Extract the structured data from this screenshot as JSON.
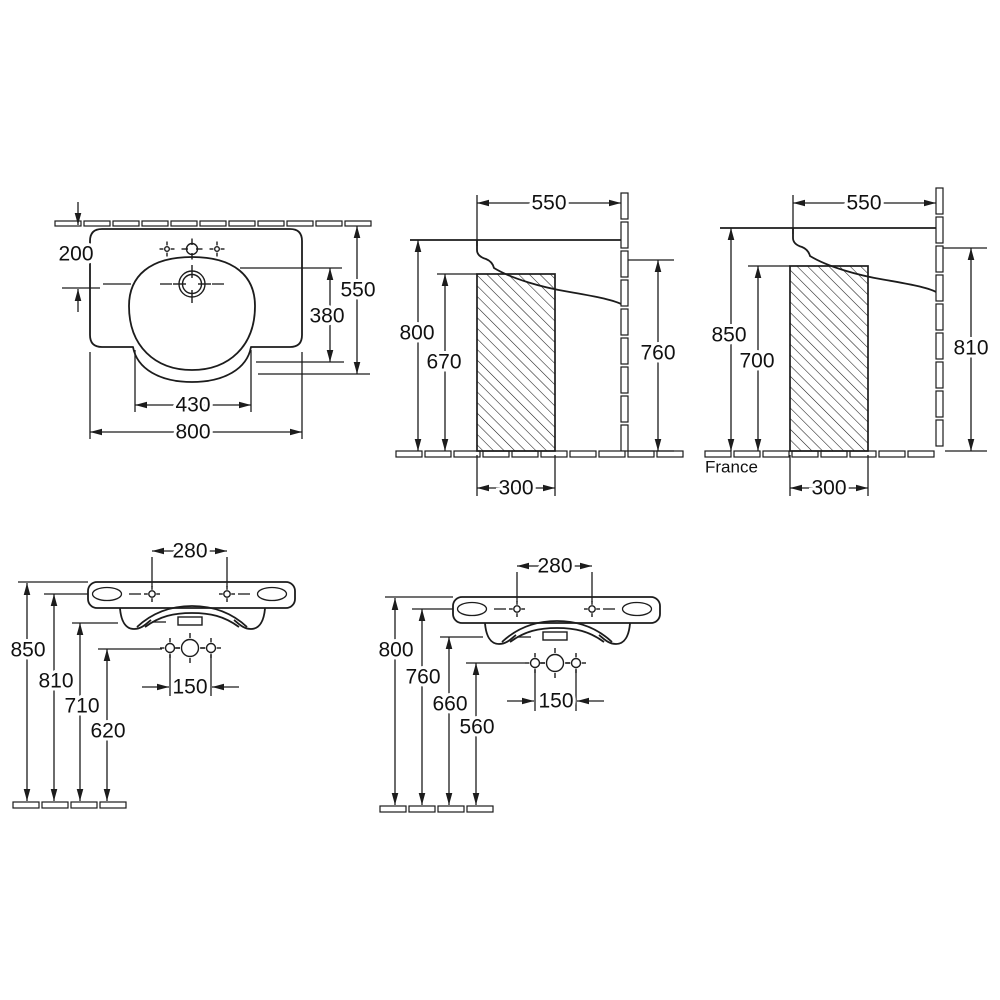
{
  "views": {
    "top": {
      "name": "top plan view",
      "wall_distance": "200",
      "depth": "550",
      "basin_depth": "380",
      "basin_width": "430",
      "width": "800"
    },
    "side": {
      "name": "side section view",
      "depth": "550",
      "front_height": "800",
      "clearance_height": "670",
      "back_height": "760",
      "service_space": "300"
    },
    "side_france": {
      "name": "side section view France",
      "region_label": "France",
      "depth": "550",
      "front_height": "850",
      "clearance_height": "700",
      "back_height": "810",
      "service_space": "300"
    },
    "front_high": {
      "name": "front elevation view high mount",
      "fixing_spacing": "280",
      "rim_height": "850",
      "fixing_height": "810",
      "apron_height": "710",
      "connection_height": "620",
      "connection_spacing": "150"
    },
    "front_low": {
      "name": "front elevation view low mount",
      "fixing_spacing": "280",
      "rim_height": "800",
      "fixing_height": "760",
      "apron_height": "660",
      "connection_height": "560",
      "connection_spacing": "150"
    }
  }
}
